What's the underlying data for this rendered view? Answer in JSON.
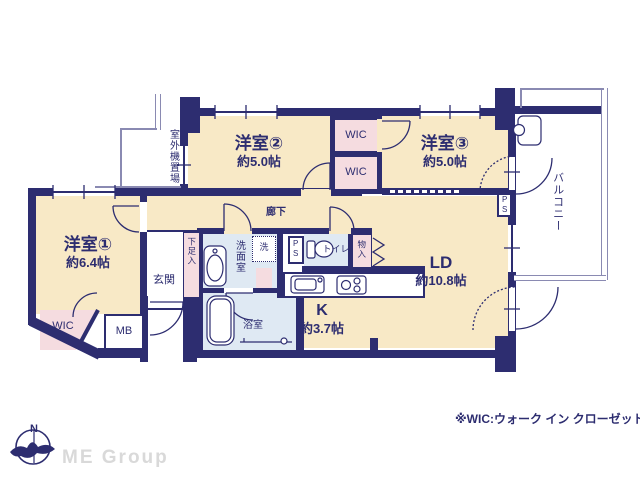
{
  "floorplan": {
    "rooms": {
      "room1": {
        "name": "洋室①",
        "size": "約6.4帖"
      },
      "room2": {
        "name": "洋室②",
        "size": "約5.0帖"
      },
      "room3": {
        "name": "洋室③",
        "size": "約5.0帖"
      },
      "ld": {
        "name": "LD",
        "size": "約10.8帖"
      },
      "kitchen": {
        "name": "K",
        "size": "約3.7帖"
      },
      "corridor": {
        "name": "廊下"
      },
      "genkan": {
        "name": "玄関"
      },
      "bath": {
        "name": "浴室"
      },
      "washroom": {
        "name": "洗面室"
      },
      "laundry": {
        "name": "洗"
      },
      "toilet": {
        "name": "トイレ"
      },
      "wic_room1": {
        "name": "WIC"
      },
      "wic_upper": {
        "name": "WIC"
      },
      "wic_lower": {
        "name": "WIC"
      },
      "shoe_closet": {
        "name": "下足入"
      },
      "storage": {
        "name": "物入"
      },
      "mb": {
        "name": "MB"
      },
      "ps_center": {
        "name": "PS"
      },
      "ps_balcony": {
        "name": "PS"
      },
      "balcony": {
        "name": "バルコニー"
      },
      "outdoor_unit": {
        "name": "室外機置場"
      }
    },
    "note": "※WIC:ウォーク イン クローゼット",
    "colors": {
      "wall": "#2d2d70",
      "room_floor": "#f8e9c6",
      "closet": "#f5dce0",
      "wet_area": "#dfe9f3",
      "outline": "#8a8ab2"
    }
  },
  "branding": {
    "company": "ME Group",
    "compass_label": "N"
  }
}
